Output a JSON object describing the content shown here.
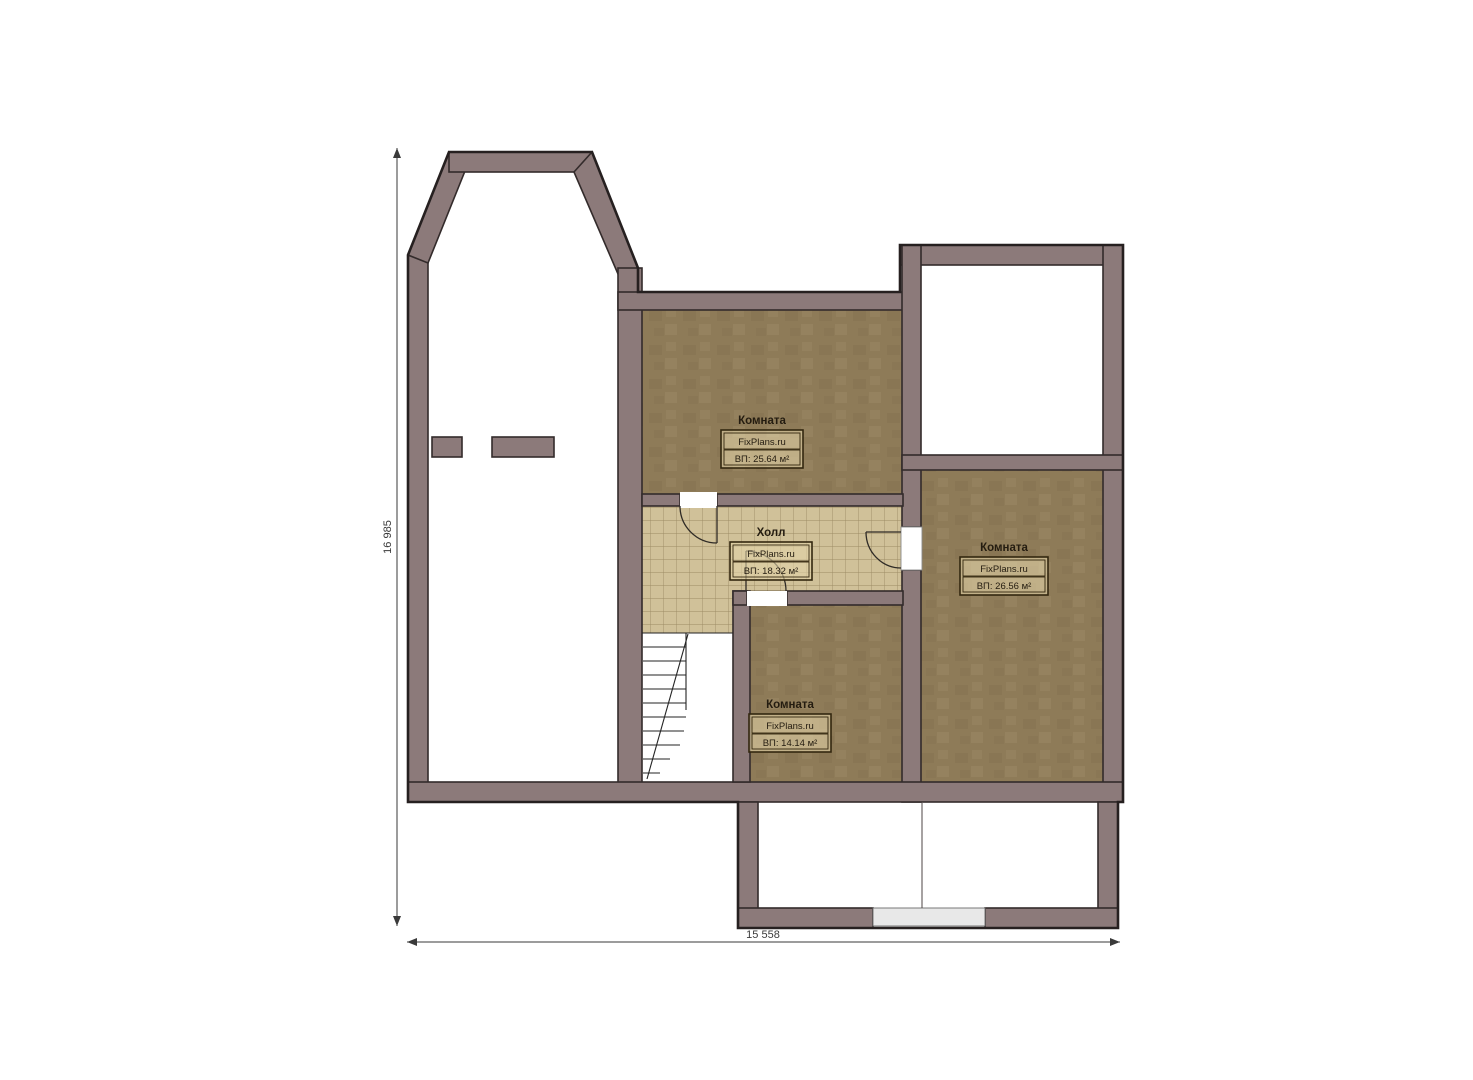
{
  "title": "Floor plan",
  "dimensions": {
    "left": "16 985",
    "bottom": "15 558"
  },
  "rooms": [
    {
      "id": "room-top",
      "title": "Комната",
      "brand": "FixPlans.ru",
      "area": "ВП: 25.64 м²"
    },
    {
      "id": "hall",
      "title": "Холл",
      "brand": "FixPlans.ru",
      "area": "ВП: 18.32 м²"
    },
    {
      "id": "room-right",
      "title": "Комната",
      "brand": "FixPlans.ru",
      "area": "ВП: 26.56 м²"
    },
    {
      "id": "room-bottom",
      "title": "Комната",
      "brand": "FixPlans.ru",
      "area": "ВП: 14.14 м²"
    }
  ],
  "colors": {
    "wall_fill": "#8C7A7A",
    "wall_stroke": "#332B2B",
    "outline_dark": "#262020",
    "floor_brown": "#8E7B58",
    "tile_base": "#D0C199",
    "tile_line": "#8A7952",
    "label_bg": "rgba(226,211,168,0.6)",
    "label_border": "#33270F",
    "label_text": "#241C10",
    "dim_color": "#3A3A3A",
    "door_gray": "#E8E8E8",
    "stair_line": "#232323"
  }
}
